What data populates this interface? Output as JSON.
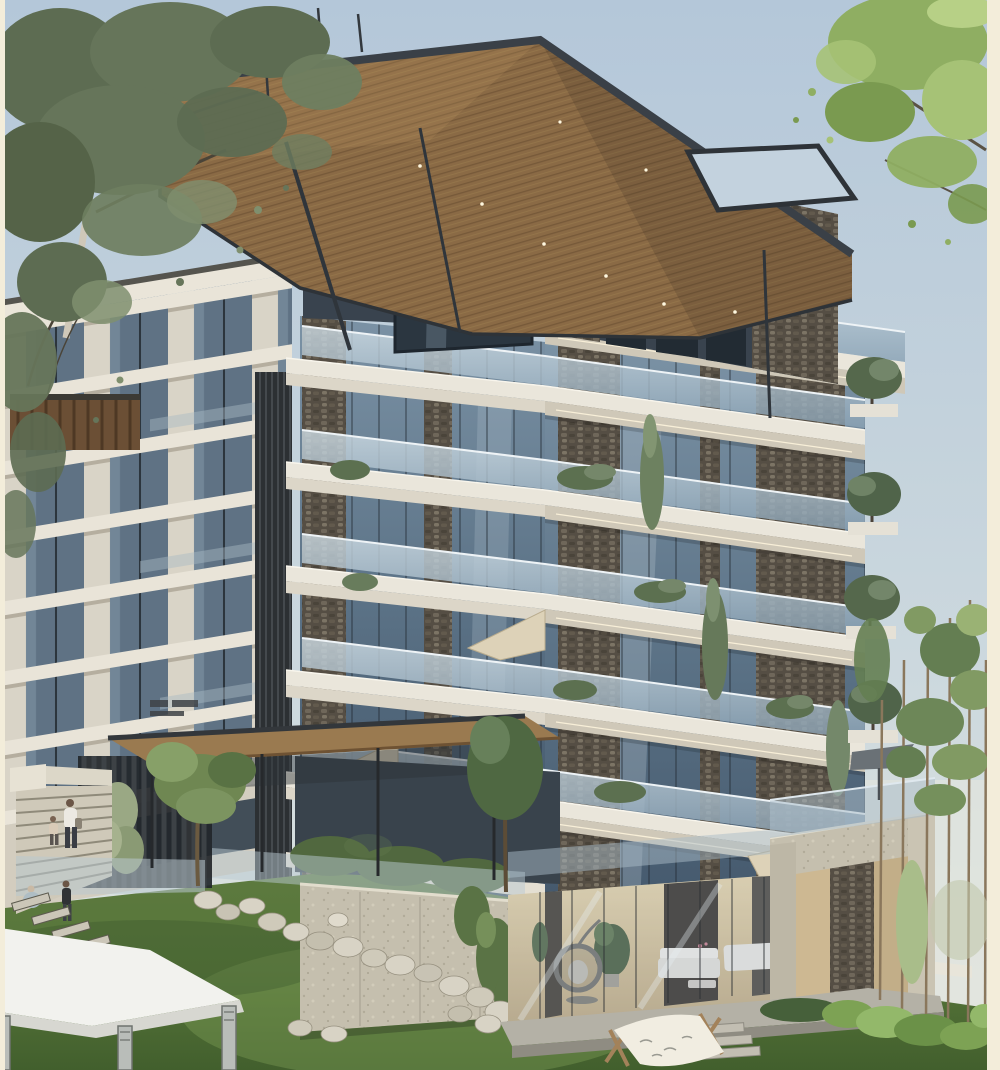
{
  "image": {
    "type": "architectural-exterior-rendering",
    "description": "Photorealistic daytime 3D rendering of a modern luxury residential complex: a stone-and-glass tower with cantilevered white balconies and a large cantilevered wood-soffit roof canopy, attached to a white concrete apartment wing, set on a sloping green lawn with boulders, stepping stones, stairs with pedestrians, a white canopy tent, a hammock, a warm-lit ground-floor lounge terrace and pine trees to the right.",
    "style": "photorealistic 3D architectural visualization",
    "time_of_day": "day",
    "width": 1000,
    "height": 1070
  },
  "palette": {
    "sky_top": "#b4c7d9",
    "sky_horizon": "#dde3e3",
    "cream_border": "#f3edda",
    "canopy_wood": "#8a6a45",
    "steel_fascia": "#3a4047",
    "stone_dark": "#57503f",
    "concrete_white": "#eae6db",
    "balcony_soffit": "#cfc8b8",
    "glass_blue": "#45586b",
    "railing_glass": "#a9bfce",
    "grass_light": "#74904e",
    "grass_dark": "#3f5c2c",
    "foliage_left_tree": "#5d6c52",
    "foliage_right_tree": "#8fae62",
    "boulder": "#d8d3c5",
    "retaining_wall": "#c5bfae",
    "warm_interior": "#e3d2a9",
    "tent_white": "#f2f2ee",
    "led_strip": "#fff6dd"
  },
  "scene": {
    "sky": {
      "clouds": "none",
      "haze_right": true
    },
    "building": {
      "left_wing": {
        "material": "white concrete",
        "floors_visible": 8,
        "windows": "vertical strip glazing",
        "balconies": "small recessed balconies",
        "roof_pergola": "brown wood slats"
      },
      "tower": {
        "material": "natural stacked stone piers with floor-to-ceiling glazing",
        "floors_visible": 6,
        "balconies": "cantilevered slabs with glass railings and LED soffit strips",
        "balcony_planters": "shrubs and small trees",
        "folded_umbrellas": 3,
        "slim_cypress_trees": 3
      },
      "penthouse": {
        "glazing": "dark full-height glass",
        "corner_glass_volume": true,
        "roof_terrace_plants": 3
      },
      "roof_canopy": {
        "material": "wood plank soffit",
        "fascia": "dark steel",
        "skylight_void": true,
        "diagonal_struts": 2,
        "soffit_downlights": 8
      },
      "entrance": {
        "canopy": "wood slab on thin steel posts",
        "sign": "small dark wall sign (illegible)",
        "slat_fence": "dark vertical louvers",
        "hedge": true
      }
    },
    "landscape": {
      "lawn_slope": true,
      "boulders_count": 18,
      "stepping_stones_count": 9,
      "retaining_wall": "board-formed concrete with hanging ivy",
      "stairs": "wide concrete steps with white parapet",
      "pine_trees_right": 6,
      "bushes_bottom_right": true,
      "canopy_tent_bottom_left": "white flat-roof pavilion with mirrored legs",
      "hammock": "white canvas on wooden A-frames"
    },
    "terrace": {
      "interior": "warm-lit lounge behind glass",
      "furniture": [
        "hanging egg chair",
        "white sofa set",
        "coffee table",
        "potted trees",
        "two sun loungers"
      ],
      "concrete_portal": true,
      "portal_roof_umbrella": "dark grey parasol",
      "deck_steps": 3
    },
    "figures": [
      {
        "type": "woman with shoulder bag",
        "location": "entrance stairs"
      },
      {
        "type": "small child",
        "location": "entrance stairs"
      },
      {
        "type": "child standing",
        "location": "lawn near stepping stones"
      },
      {
        "type": "child crouching",
        "location": "lawn near stepping stones"
      }
    ],
    "border": {
      "left_width_px": 5,
      "right_width_px": 13,
      "color": "#f3edda"
    }
  }
}
